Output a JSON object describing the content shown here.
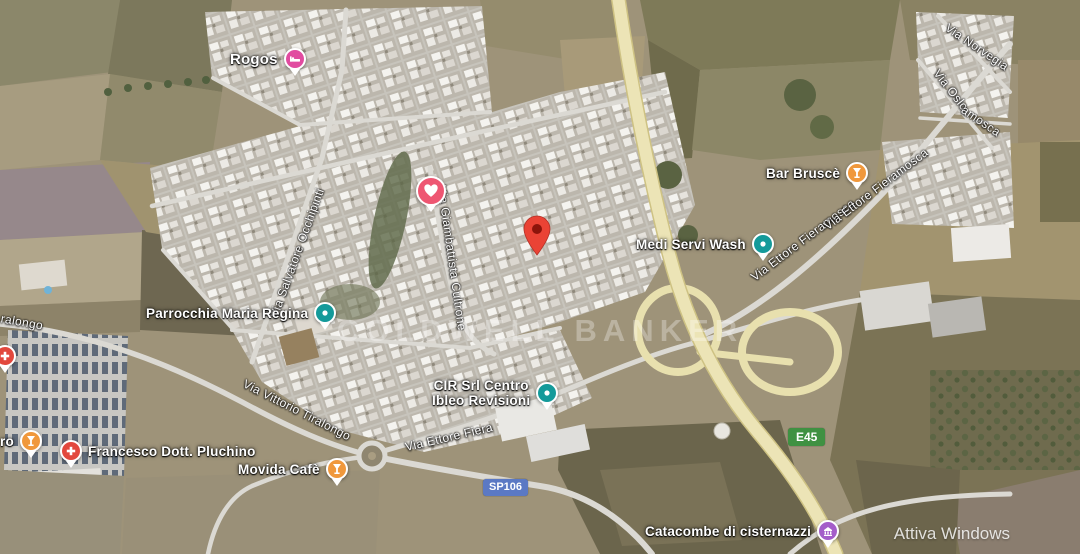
{
  "map": {
    "brand_watermark": "COLDWELL BANKER",
    "os_watermark": "Attiva Windows"
  },
  "road_badges": [
    {
      "label": "SP106",
      "color": "#5b79c4"
    },
    {
      "label": "E45",
      "color": "#3f9142"
    }
  ],
  "street_labels": [
    {
      "name": "Via Salvatore Occhipinti"
    },
    {
      "name": "Via Giambattista Cultrone"
    },
    {
      "name": "Via Vittorio Tiralongo"
    },
    {
      "name": "ralongo"
    },
    {
      "name": "Via Ettore Fieramosca"
    },
    {
      "name": "Via Ettore Fieramosca"
    },
    {
      "name": "Via Ettore Fiera"
    },
    {
      "name": "Via Norvegia"
    },
    {
      "name": "Via Oslo"
    },
    {
      "name": "amosca"
    }
  ],
  "places": [
    {
      "name": "Rogos",
      "icon": "hotel",
      "color": "#e14ba0"
    },
    {
      "name": "",
      "icon": "favorite-heart",
      "color": "#ee5672"
    },
    {
      "name": "Parrocchia Maria Regina",
      "icon": "generic-poi",
      "color": "#149a9a"
    },
    {
      "name": "",
      "icon": "destination-marker",
      "color": "#ea4335"
    },
    {
      "name": "Medi Servi Wash",
      "icon": "generic-poi",
      "color": "#149a9a"
    },
    {
      "name": "Bar Bruscè",
      "icon": "bar",
      "color": "#f0983c"
    },
    {
      "name": "CIR Srl Centro",
      "name2": "Ibleo Revisioni",
      "icon": "generic-poi",
      "color": "#149a9a"
    },
    {
      "name": "Francesco Dott. Pluchino",
      "icon": "medical",
      "color": "#e2483d"
    },
    {
      "name": "Movida Cafè",
      "icon": "bar",
      "color": "#f0983c"
    },
    {
      "name": "Catacombe di cisternazzi",
      "icon": "attraction",
      "color": "#a45dc9"
    },
    {
      "name": "",
      "icon": "medical",
      "color": "#e2483d"
    },
    {
      "name": "ro",
      "icon": "bar",
      "color": "#f0983c"
    }
  ]
}
